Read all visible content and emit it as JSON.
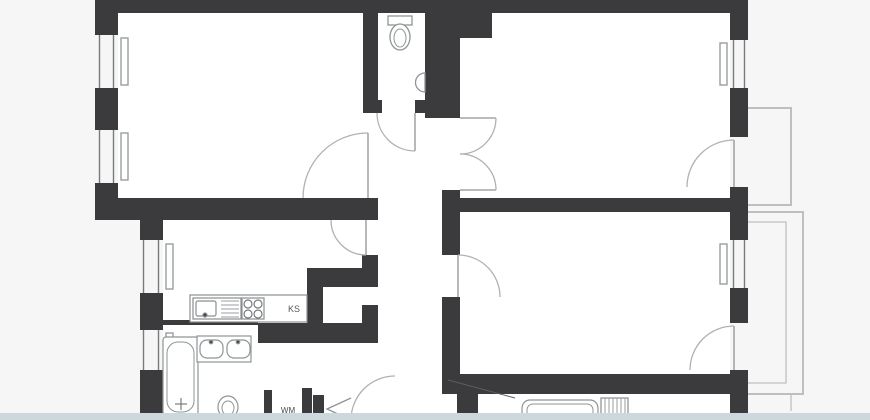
{
  "plan": {
    "type": "apartment-floor-plan",
    "labels": {
      "fridge_space": "KS",
      "washing_machine_space": "WM"
    },
    "palette": {
      "wall": "#3b3b3d",
      "fixture_line": "#8f9496",
      "door_arc": "#aeb2b4",
      "balcony_line": "#bcc0c2",
      "room_fill": "#ffffff",
      "background": "#f6f6f6",
      "footer_bar": "#ccd8dc"
    },
    "fixtures": [
      "toilet",
      "corner-washbasin",
      "kitchen-sink",
      "stove-4-burner",
      "fridge-space",
      "bathtub",
      "double-washbasin",
      "toilet",
      "washing-machine-space",
      "radiator",
      "basin-unit",
      "balcony-upper",
      "balcony-lower"
    ],
    "counts": {
      "windows": 6,
      "door_swings": 9,
      "double_doors": 1,
      "bifold_doors": 1
    }
  }
}
